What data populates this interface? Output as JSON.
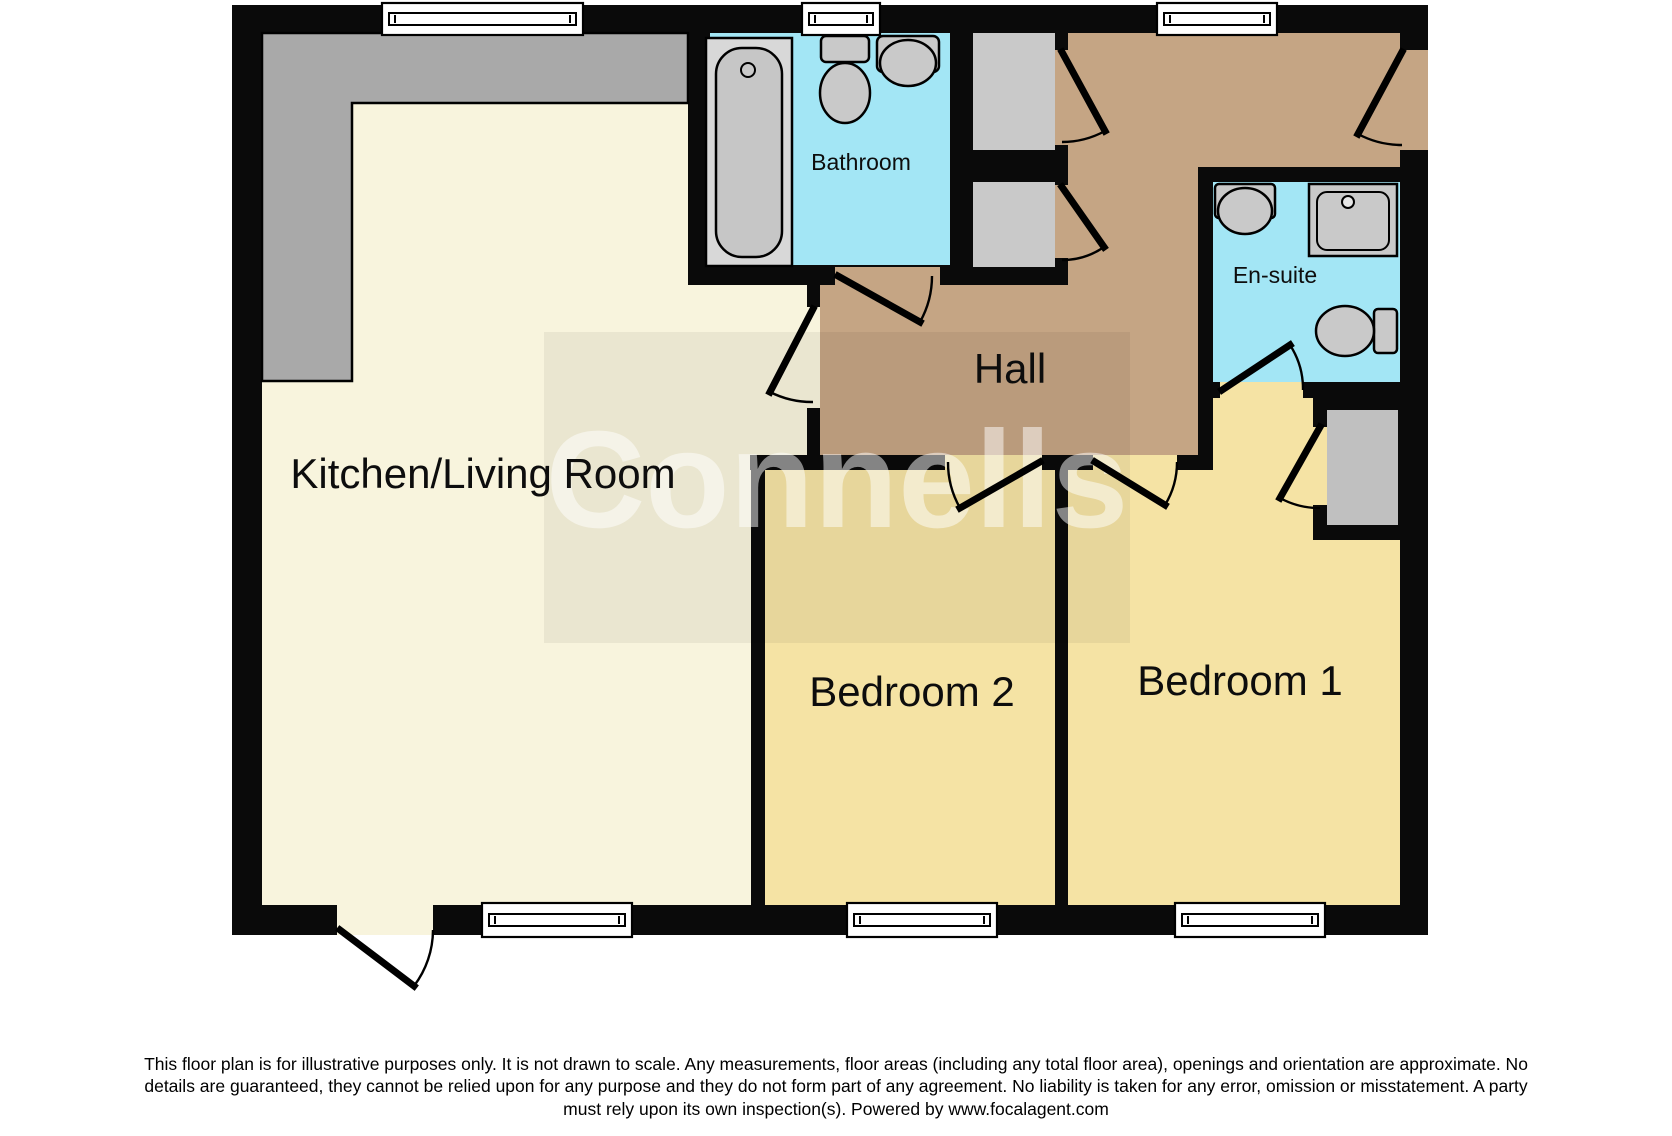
{
  "floor_plan": {
    "rooms": {
      "kitchen_living": "Kitchen/Living Room",
      "hall": "Hall",
      "bathroom": "Bathroom",
      "ensuite": "En-suite",
      "bedroom1": "Bedroom 1",
      "bedroom2": "Bedroom 2"
    },
    "watermark": "Connells"
  },
  "disclaimer": {
    "line1": "This floor plan is for illustrative purposes only. It is not drawn to scale. Any measurements, floor areas (including any total floor area), openings and orientation are approximate. No",
    "line2": "details are guaranteed, they cannot be relied upon for any purpose and they do not form part of any agreement. No liability is taken for any error, omission or misstatement. A party",
    "line3": "must rely upon its own inspection(s). Powered by www.focalagent.com"
  },
  "colors": {
    "wall": "#0a0a0a",
    "kitchen": "#f8f4dd",
    "hall": "#c5a584",
    "bedroom": "#f5e3a4",
    "wet": "#a3e6f5",
    "counter": "#a9a9a9",
    "storage": "#c9c9c9",
    "closet": "#c0c0c0",
    "fixture": "#c9c9c9",
    "fixture_light": "#d8d8d8",
    "tub": "#c6c6c6",
    "watermark_box": "rgba(0,0,0,0.055)",
    "watermark_text": "rgba(255,255,255,0.5)"
  }
}
